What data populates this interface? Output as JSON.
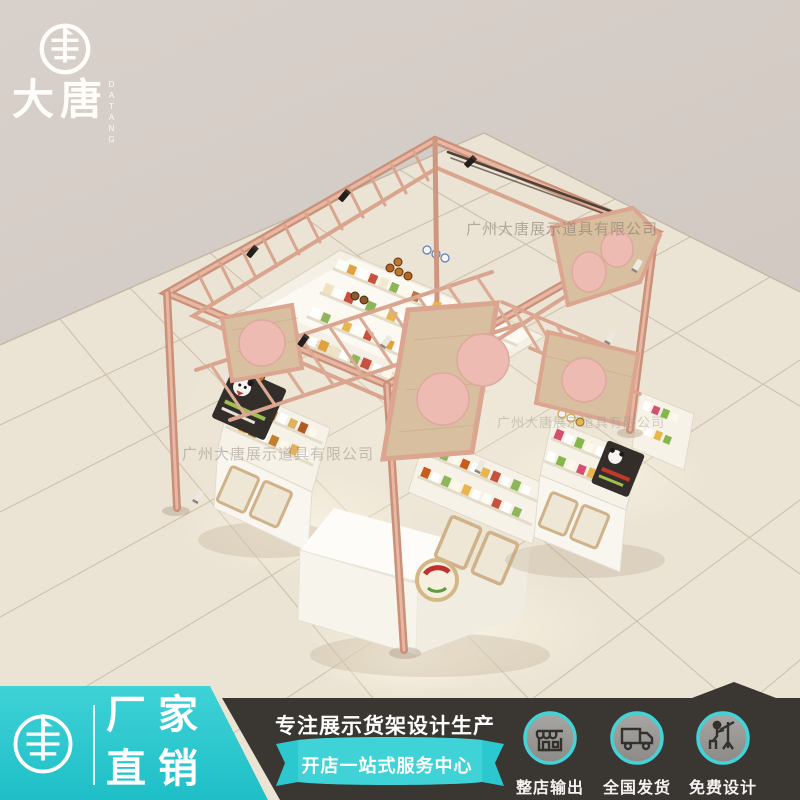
{
  "brand": {
    "name": "大唐",
    "name_en": "DATANG"
  },
  "watermark": {
    "text": "广州大唐展示道具有限公司"
  },
  "banner": {
    "left": {
      "line1": "厂家",
      "line2": "直销"
    },
    "middle": {
      "title": "专注展示货架设计生产",
      "subtitle": "开店一站式服务中心"
    },
    "services": [
      {
        "icon": "storefront-icon",
        "label": "整店输出"
      },
      {
        "icon": "truck-icon",
        "label": "全国发货"
      },
      {
        "icon": "designer-icon",
        "label": "免费设计"
      }
    ]
  },
  "scene": {
    "subject": "rose-gold frame mall kiosk with display cabinets on tiled floor"
  },
  "colors": {
    "teal": "#2cc8cf",
    "banner_dark": "#3a3632",
    "rose_gold": "#dfa893",
    "panel_wood": "#d8bfa0",
    "disc_pink": "#edbbb2",
    "floor": "#ebe3d3",
    "wall": "#d6cec7"
  }
}
